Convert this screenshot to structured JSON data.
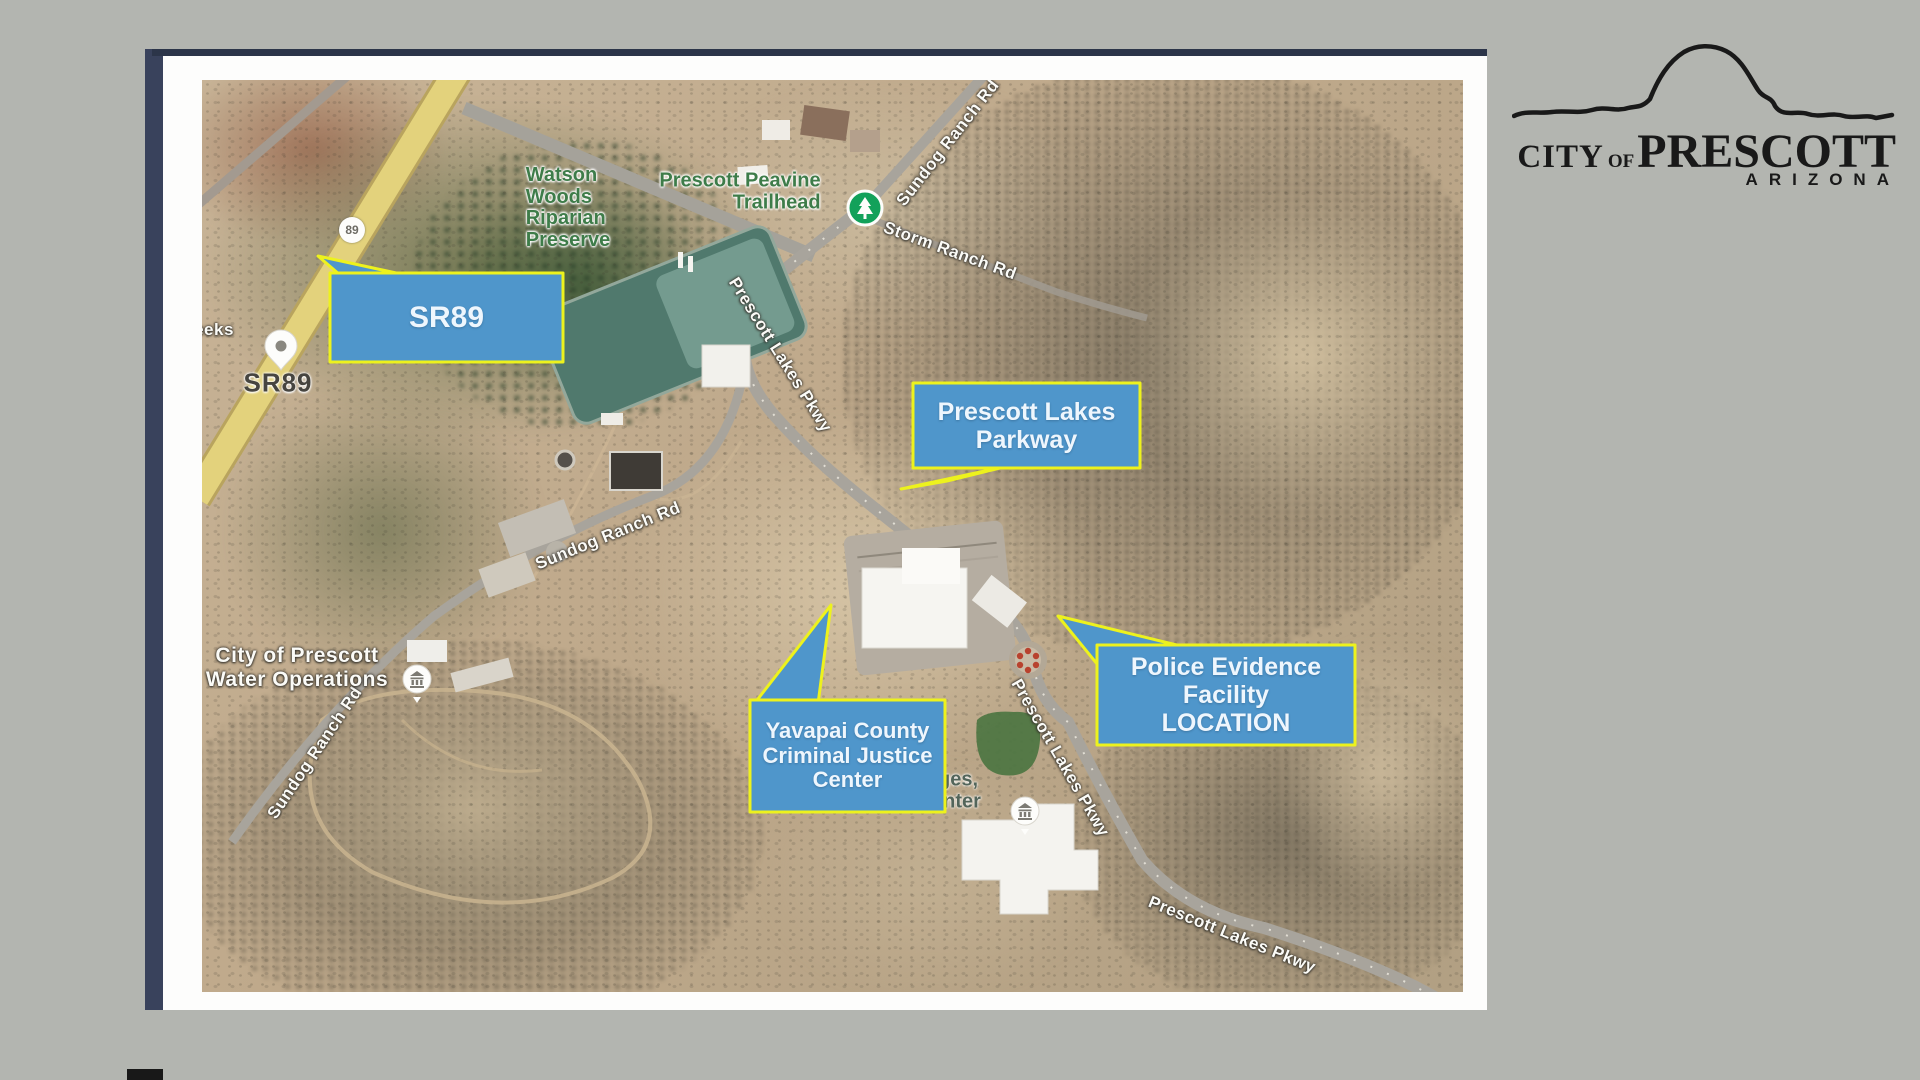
{
  "page": {
    "background": "#b3b5b0",
    "slide_frame_color": "#39425c"
  },
  "logo": {
    "city": "CITY",
    "of": "OF",
    "name": "PRESCOTT",
    "state": "ARIZONA"
  },
  "map_labels": {
    "partial_left": "eeks",
    "route_shield": "89",
    "sr89_road": "SR89",
    "watson_woods": "Watson\nWoods\nRiparian\nPreserve",
    "peavine": "Prescott Peavine\nTrailhead",
    "sundog_ne": "Sundog Ranch Rd",
    "storm": "Storm Ranch Rd",
    "pkwy_upper": "Prescott Lakes Pkwy",
    "sundog_mid": "Sundog Ranch Rd",
    "sundog_sw": "Sundog Ranch Rd",
    "water_ops": "City of Prescott\nWater Operations",
    "pkwy_mid": "Prescott Lakes Pkwy",
    "pkwy_se": "Prescott Lakes Pkwy",
    "partial_center_1": "ges,",
    "partial_center_2": "nter"
  },
  "callouts": {
    "sr89": "SR89",
    "parkway": "Prescott Lakes\nParkway",
    "justice_center": "Yavapai County\nCriminal Justice\nCenter",
    "police_facility": "Police Evidence\nFacility\nLOCATION"
  },
  "colors": {
    "callout_fill": "#4f96cb",
    "callout_border": "#edf21d",
    "highway_yellow": "#e3d27c",
    "poi_green": "#3e7c49",
    "trailhead_marker_green": "#12a15a",
    "road_gray": "#a8a49c"
  }
}
